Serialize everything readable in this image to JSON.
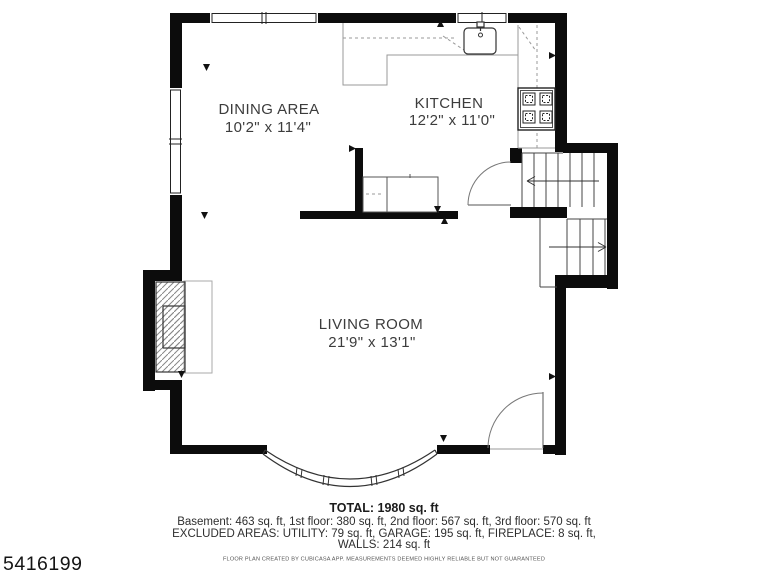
{
  "listing_id": "5416199",
  "plan": {
    "rooms": [
      {
        "name": "DINING AREA",
        "dims": "10'2\" x 11'4\""
      },
      {
        "name": "KITCHEN",
        "dims": "12'2\" x 11'0\""
      },
      {
        "name": "LIVING ROOM",
        "dims": "21'9\" x 13'1\""
      }
    ]
  },
  "summary": {
    "total": "TOTAL: 1980 sq. ft",
    "floors": "Basement: 463 sq. ft, 1st floor: 380 sq. ft, 2nd floor: 567 sq. ft, 3rd floor: 570 sq. ft",
    "excluded": "EXCLUDED AREAS: UTILITY: 79 sq. ft, GARAGE: 195 sq. ft, FIREPLACE: 8 sq. ft,",
    "walls": "WALLS: 214 sq. ft"
  },
  "disclaimer": "FLOOR PLAN CREATED BY CUBICASA APP. MEASUREMENTS DEEMED HIGHLY RELIABLE BUT NOT GUARANTEED",
  "colors": {
    "wall": "#0c0c0c",
    "thin_line": "#555555",
    "counter_line": "#999999",
    "label_text": "#3c3c3c"
  }
}
